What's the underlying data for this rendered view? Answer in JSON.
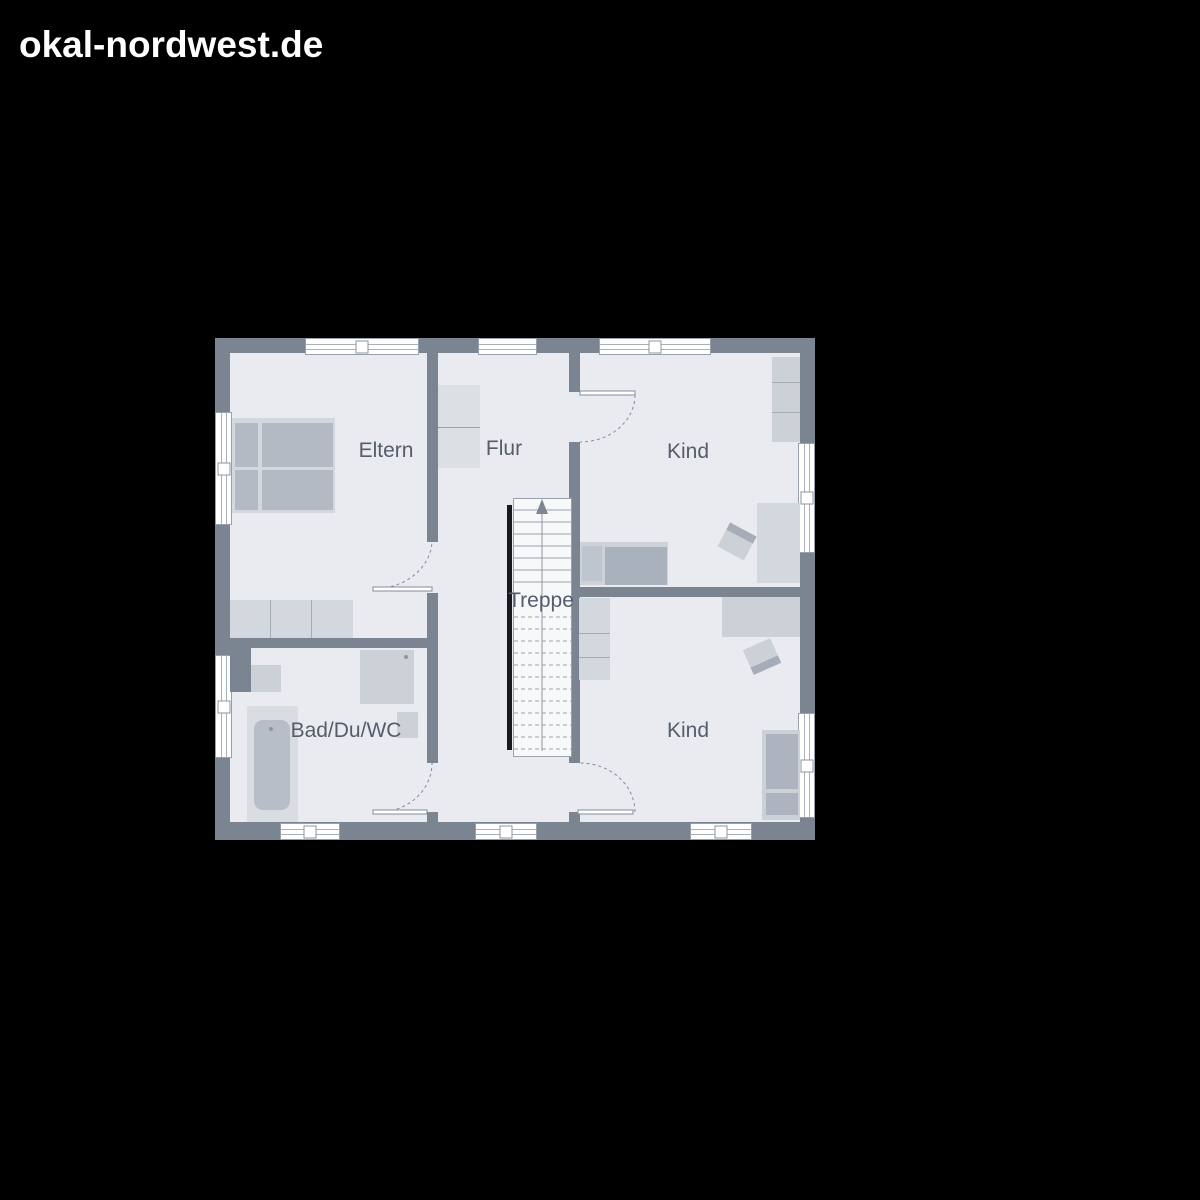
{
  "page": {
    "background": "#000000"
  },
  "header": {
    "site_name": "okal-nordwest.de"
  },
  "floor_plan": {
    "rooms": [
      {
        "id": "eltern",
        "label": "Eltern"
      },
      {
        "id": "flur",
        "label": "Flur"
      },
      {
        "id": "kind_top",
        "label": "Kind"
      },
      {
        "id": "treppe",
        "label": "Treppe"
      },
      {
        "id": "bad_du_wc",
        "label": "Bad/Du/WC"
      },
      {
        "id": "kind_bottom",
        "label": "Kind"
      }
    ],
    "colors": {
      "wall": "#7b8591",
      "floor": "#e9ebf1",
      "furniture_light": "#d3d8de",
      "furniture_dark": "#b3bac4",
      "window": "#ffffff",
      "outline": "#98a0ab",
      "label_text": "#545d6a",
      "stair_stringer": "#17191d"
    }
  }
}
